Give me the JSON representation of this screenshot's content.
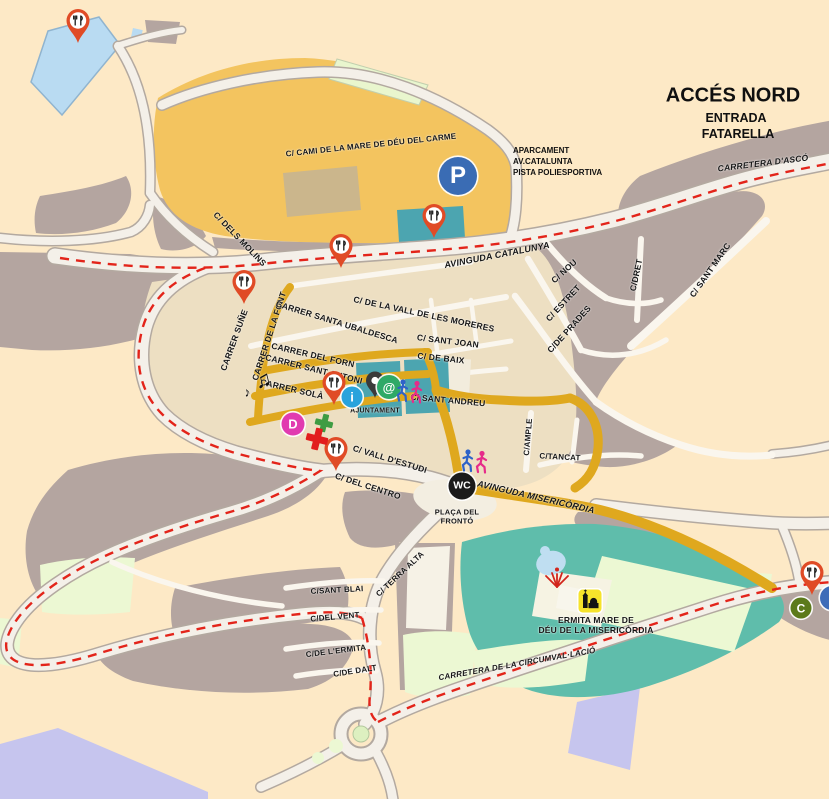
{
  "region_title": {
    "line1": "ACCÉS NORD",
    "line2": "ENTRADA",
    "line3": "FATARELLA"
  },
  "roads": {
    "cami": "C/ CAMI DE LA MARE DE DÉU DEL CARME",
    "catalunya": "AVINGUDA CATALUNYA",
    "asco": "CARRETERA D'ASCÓ",
    "molins": "C/ DELS MOLINS",
    "sune": "CARRER SUÑE",
    "font": "CARRER DE LA FONT",
    "ubaldesca": "CARRER SANTA UBALDESCA",
    "moreres": "C/ DE LA VALL DE LES MORERES",
    "nou": "C/ NOU",
    "estret": "C/ ESTRET",
    "prades": "C/DE PRADES",
    "dret": "C/DRET",
    "marc": "C/ SANT MARC",
    "forn": "CARRER DEL FORN",
    "antoni": "CARRER SANT ANTONI",
    "sola": "CARRER SOLÀ",
    "joan": "C/ SANT JOAN",
    "baix": "C/ DE BAIX",
    "andreu": "C/ SANT ANDREU",
    "ample": "C/AMPLE",
    "tancat": "C/TANCAT",
    "vall_estudi": "C/ VALL D'ESTUDI",
    "centro": "C/ DEL CENTRO",
    "misericordia": "AVINGUDA MISERICÒRDIA",
    "terra_alta": "C/ TERRA ALTA",
    "blai": "C/SANT BLAI",
    "vent": "C/DEL VENT",
    "ermita_st": "C/DE L'ERMITA",
    "dalt": "C/DE DALT",
    "circumval": "CARRETERA DE LA CIRCUMVAL·LACIÓ"
  },
  "places": {
    "aparcament_line1": "APARCAMENT",
    "aparcament_line2": "AV.CATALUNTA",
    "aparcament_line3": "PISTA POLIESPORTIVA",
    "ajuntament": "AJUNTAMENT",
    "placa_line1": "PLAÇA DEL",
    "placa_line2": "FRONTÓ",
    "ermita_line1": "ERMITA MARE DE",
    "ermita_line2": "DÉU DE LA MISERICÒRDIA"
  },
  "markers": {
    "parking": "P",
    "wc": "WC",
    "info": "i",
    "internet": "@",
    "d_badge": "D",
    "c_badge": "C",
    "music_note": "♫",
    "music_note_small": "♪"
  },
  "icons": {
    "restaurant": "fork-knife-pin",
    "town_hall": "dark-pin",
    "pharmacy": "cross",
    "chapel": "church-badge",
    "route_runners": "runner-figures"
  },
  "colors": {
    "background": "#FDE9C6",
    "route_yellow": "#DFA81E",
    "dashed_red": "#E3241A",
    "parking_blue": "#3A6CB4",
    "info_blue": "#29A3DC",
    "internet_green": "#2EA967",
    "d_magenta": "#E13BB0",
    "c_olive": "#5C7A1B",
    "pin_red": "#E04B26",
    "teal_building": "#4CA5B0",
    "ermita_teal": "#5FBDAB"
  }
}
